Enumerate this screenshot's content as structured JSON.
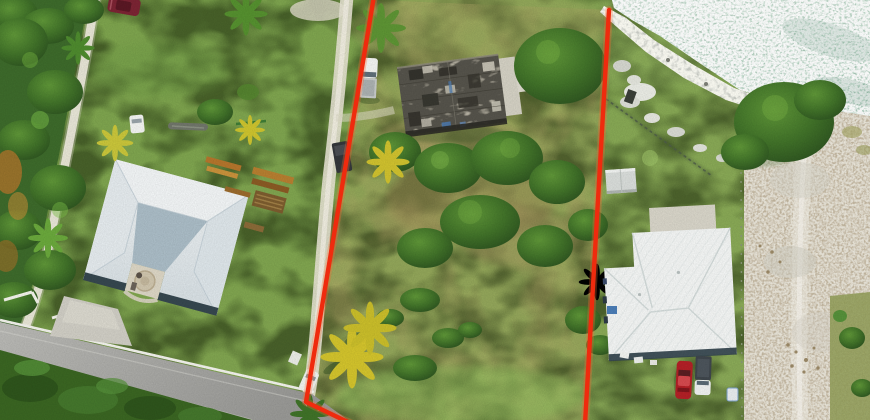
{
  "scene": {
    "type": "aerial-drone-photograph",
    "subject": "vacant grassy waterfront lot outlined with a red property-boundary overlay",
    "setting": "residential coastal neighborhood, top-down view",
    "regions": {
      "top_right": "sparkling teal sea with rocky shoreline",
      "right": "white sand cleared area beside neighboring house",
      "bottom_left": "gray asphalt road with white curb and roadside bushes",
      "left": "dense tree line with white sandy footpath",
      "center": "listed lot with old shingled cottage, fruit trees and yellow palms"
    }
  },
  "boundary": {
    "label": "property-boundary-lines",
    "color": "#ef2b0e",
    "segments": 2,
    "left_line": "from top edge down to road corner then to bottom edge",
    "right_line": "from shoreline straight down to bottom edge"
  },
  "objects": {
    "left-house": "large light-gray hip-roof house with center courtyard patio and concrete driveway",
    "courtyard-patio": "beige patio with circular stone feature",
    "lumber-piles": "orange-brown boards and pallet stack on lawn",
    "center-building": "small cottage with weathered mottled shingle roof and concrete pad",
    "pickup-truck-white": "white pickup truck parked beside cottage",
    "dark-trailer": "dark vehicle on white dirt drive",
    "right-house": "white metal hip-roof house with concrete pad and small shed",
    "car-red": "red car in right driveway",
    "truck-gray": "gray/white truck beside red car",
    "car-maroon": "maroon car at top-left",
    "car-white-small": "small white car on left lawn",
    "car-white-road": "white car at road end",
    "log-boat": "long gray log on lawn",
    "water": "sun-sparkled sea surface",
    "shoreline-rocks": "white-gray limestone rocks along waterline",
    "sand-area": "white sand clearing with tire tracks",
    "road": "asphalt road with white retaining curb",
    "palms": "yellow and green palm trees",
    "tree-canopies": "dense green fruit-tree cluster on the lot",
    "fence-shore": "dark fence running from shore into lot",
    "fence-sand": "post line between lawn and sand"
  },
  "palette": {
    "boundary_red": "#ef2b0e",
    "grass_base": "#85a754",
    "olive": "#9aa45e",
    "tree_dark": "#38622a",
    "palm_yellow": "#d2c32c",
    "palm_green": "#5d9434",
    "path_white": "#ebe8da",
    "road_gray": "#a6a6a2",
    "curb_white": "#f2f2ec",
    "bush_dark": "#3a6522",
    "roof_left": "#e9edef",
    "roof_left_dark": "#aabcc6",
    "eave_dark": "#36474f",
    "roof_old": "#55534b",
    "roof_right": "#f3f5f4",
    "concrete": "#d7d4c8",
    "sand": "#e9e5d9",
    "rock": "#cbcec7",
    "water": "#a9c4b3",
    "car_red": "#b22026",
    "car_maroon": "#7b2433",
    "vehicle_white": "#f2f3f1",
    "vehicle_dark": "#34373b"
  }
}
